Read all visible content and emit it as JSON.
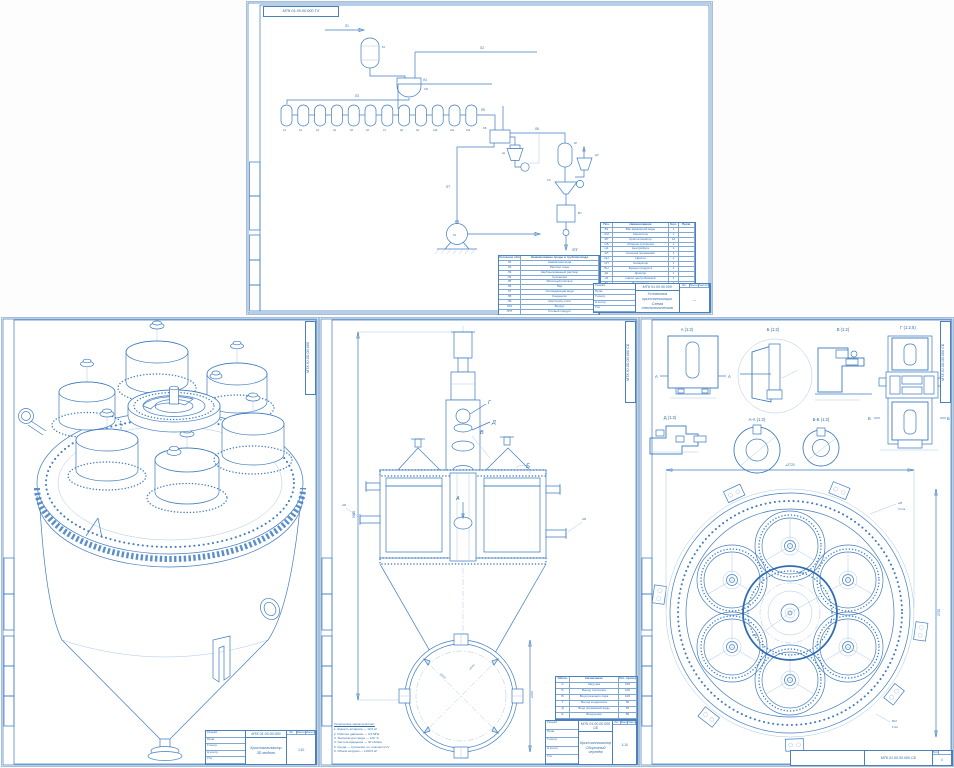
{
  "colors": {
    "line": "#3f7cc0",
    "light": "#aac7e6",
    "dark": "#2e6da8",
    "hatch": "#7fa8d6",
    "bold": "#2f6db4"
  },
  "sheet_top": {
    "corner_code": "МТК 01.00.00.000 ТХ",
    "stream_labels": {
      "l1": "Л1",
      "l2": "Л2",
      "l3": "Л3",
      "l4": "Л4",
      "l5": "Л5",
      "l6": "Л6",
      "lt": "ЛТ",
      "lpg": "ЛПГ"
    },
    "vessel_labels": [
      "А1",
      "А2",
      "А3",
      "А4",
      "А5",
      "А6",
      "А7",
      "А8",
      "А9",
      "А10",
      "А11",
      "А12"
    ],
    "eq_labels": {
      "tank": "Б1",
      "mixer": "СМ",
      "collector": "СБ",
      "cyclone": "Ц1",
      "column": "КЛ",
      "cyclone2": "ЦН",
      "separator": "СП",
      "bunker": "БН",
      "pump": "Н1"
    },
    "legend_table": {
      "headers": [
        "Условное обозначение",
        "Наименование среды в трубопроводе"
      ],
      "rows": [
        [
          "Л1",
          "Аммиачная вода"
        ],
        [
          "Л2",
          "Раствор соды"
        ],
        [
          "Л3",
          "Карбонизованный раствор"
        ],
        [
          "Л4",
          "Суспензия"
        ],
        [
          "Л5",
          "Маточный раствор"
        ],
        [
          "Л6",
          "Пар"
        ],
        [
          "Л7",
          "Охлаждающая вода"
        ],
        [
          "Л8",
          "Конденсат"
        ],
        [
          "Л9",
          "Кристаллы соли"
        ],
        [
          "Л10",
          "Воздух"
        ],
        [
          "ЛПГ",
          "Готовый продукт"
        ]
      ]
    },
    "equipment_table": {
      "headers": [
        "Поз.",
        "Наименование",
        "Кол.",
        "Прим."
      ],
      "rows": [
        [
          "Б1",
          "Бак аммиачной воды",
          "1",
          ""
        ],
        [
          "СМ",
          "Смеситель",
          "1",
          ""
        ],
        [
          "КР",
          "Кристаллизатор",
          "12",
          ""
        ],
        [
          "СБ",
          "Сборник суспензии",
          "1",
          ""
        ],
        [
          "Ц1",
          "Центрифуга",
          "1",
          ""
        ],
        [
          "КЛ",
          "Колонна промывная",
          "1",
          ""
        ],
        [
          "ЦН",
          "Циклон",
          "1",
          ""
        ],
        [
          "СП",
          "Сепаратор",
          "1",
          ""
        ],
        [
          "БН",
          "Бункер продукта",
          "1",
          ""
        ],
        [
          "Д1",
          "Дозатор",
          "1",
          ""
        ],
        [
          "Н1",
          "Насос центробежный",
          "1",
          ""
        ],
        [
          "В1",
          "Вентилятор",
          "1",
          ""
        ],
        [
          "Т1",
          "Транспортер",
          "1",
          ""
        ]
      ]
    },
    "title_block": {
      "code": "МТК 01.00.00.000",
      "title1": "Установка кристаллизации",
      "title2": "Схема технологическая",
      "roles": [
        [
          "Разраб."
        ],
        [
          "Пров."
        ],
        [
          "Т.контр."
        ],
        [
          "Н.контр."
        ],
        [
          "Утв."
        ]
      ],
      "lit": "Лит.",
      "mass": "Масса",
      "scale": "Масштаб",
      "scale_val": "—"
    }
  },
  "sheet_iso": {
    "edge_code": "МТК 01.00.00.000",
    "title_block": {
      "code": "МТК 01.00.00.000",
      "title": "Кристаллизатор",
      "subtitle": "3D модель",
      "roles": [
        [
          "Разраб."
        ],
        [
          "Пров."
        ],
        [
          "Т.контр."
        ],
        [
          "Н.контр."
        ],
        [
          "Утв."
        ]
      ],
      "lit": "Лит.",
      "mass": "Масса",
      "scale": "Масштаб",
      "scale_val": "1:10"
    }
  },
  "sheet_front": {
    "edge_code": "МТК 01.00.00.000 СБ",
    "view_letters": {
      "a": "А",
      "b": "Б",
      "v": "В",
      "g": "Г",
      "d": "Д"
    },
    "dims": {
      "height": "5960",
      "dia1": "⌀2720",
      "dia2": "⌀2420",
      "tip": "⌀150",
      "noz": "⌀50"
    },
    "notes_title": "Технические характеристики:",
    "notes": [
      "1. Ёмкость аппарата — 12,5 м³",
      "2. Рабочее давление — 0,6 МПа",
      "3. Температура среды — 120 °С",
      "4. Частота вращения — 30 об/мин",
      "5. Среда — суспензия, кл. опасности IV",
      "6. Объём загрузки — 10±0,5 м³"
    ],
    "nozzle_table": {
      "headers": [
        "Обозн.",
        "Назначение",
        "Усл. проход"
      ],
      "rows": [
        [
          "А",
          "Загрузка",
          "150"
        ],
        [
          "Б",
          "Выход суспензии",
          "100"
        ],
        [
          "В",
          "Вход греющего пара",
          "100"
        ],
        [
          "Г",
          "Выход конденсата",
          "50"
        ],
        [
          "Д",
          "Вход промывной воды",
          "50"
        ],
        [
          "Е",
          "Воздушник",
          "80"
        ]
      ]
    },
    "title_block": {
      "code": "МТК 01.00.00.000 СБ",
      "title": "Кристаллизатор",
      "subtitle": "Сборочный чертёж",
      "roles": [
        [
          "Разраб."
        ],
        [
          "Пров."
        ],
        [
          "Т.контр."
        ],
        [
          "Н.контр."
        ],
        [
          "Утв."
        ]
      ],
      "lit": "Лит.",
      "mass": "Масса",
      "scale": "Масштаб",
      "scale_val": "1:10"
    }
  },
  "sheet_details": {
    "edge_code": "МТК 01.00.00.000 СБ",
    "views": {
      "a": "А (1:2)",
      "b": "Б (1:2)",
      "v": "В (1:2)",
      "g": "Г (1:2.5)",
      "d": "Д (1:2)",
      "aa": "А-А (1:2)",
      "bb": "Б-Б (1:2)"
    },
    "section_marks": {
      "a": "А",
      "b": "Б"
    },
    "dims": {
      "top": "⌀2720",
      "right": "2720",
      "holes": "⌀25",
      "holes_n": "72 отв.",
      "bolts": "М24",
      "bolts_n": "6 отв.",
      "drum": "⌀670",
      "ring": "⌀920"
    },
    "bottom_code": "МТК 01.00.00.000 СБ",
    "sheet_label": "Лист",
    "sheet_no": "4"
  }
}
